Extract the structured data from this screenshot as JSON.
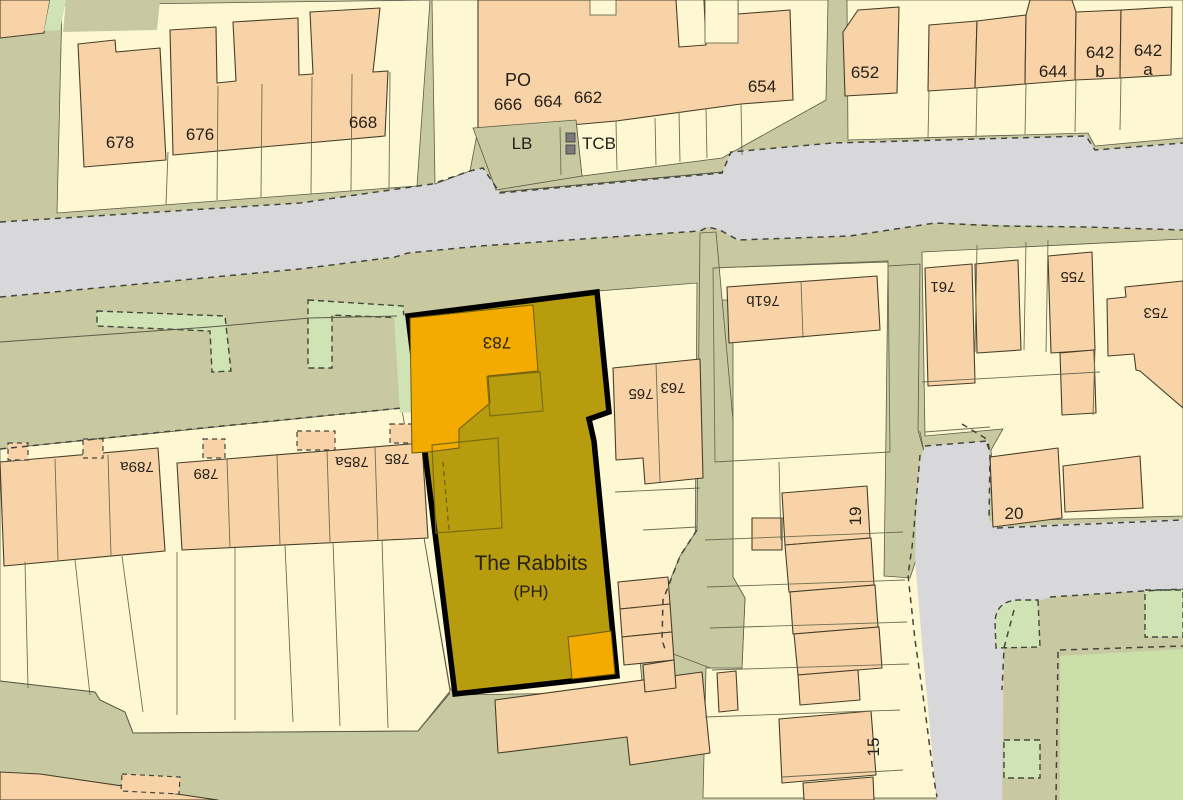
{
  "map_title": "Site location plan — The Rabbits (PH)",
  "site": {
    "name": "The Rabbits",
    "type": "(PH)"
  },
  "labels": {
    "b678": "678",
    "b676": "676",
    "b668": "668",
    "po": "PO",
    "b666": "666",
    "b664": "664",
    "b662": "662",
    "b654": "654",
    "lb": "LB",
    "tcb": "TCB",
    "b652": "652",
    "b644": "644",
    "b642b": {
      "l1": "642",
      "l2": "b"
    },
    "b642a": {
      "l1": "642",
      "l2": "a"
    },
    "b783": "783",
    "b765": "765",
    "b763": "763",
    "b761b": "761b",
    "b761": "761",
    "b755": "755",
    "b753": "753",
    "b789a": "789a",
    "b789": "789",
    "b785a": "785a",
    "b785": "785",
    "b19": "19",
    "b20": "20",
    "b15": "15"
  },
  "colors": {
    "road": "#d8d8da",
    "verge": "#c8c9a1",
    "parcel": "#fdf8d2",
    "building": "#f7d3a7",
    "building_outline": "#473f2a",
    "green_strip": "#cfe3b4",
    "field": "#cbe0a8",
    "site_fill": "#b79d0e",
    "site_outline": "#000000",
    "site_building": "#f3ab00",
    "label": "#26211a",
    "dashed_line": "#44463c",
    "marker_grey": "#7a7a7a"
  }
}
